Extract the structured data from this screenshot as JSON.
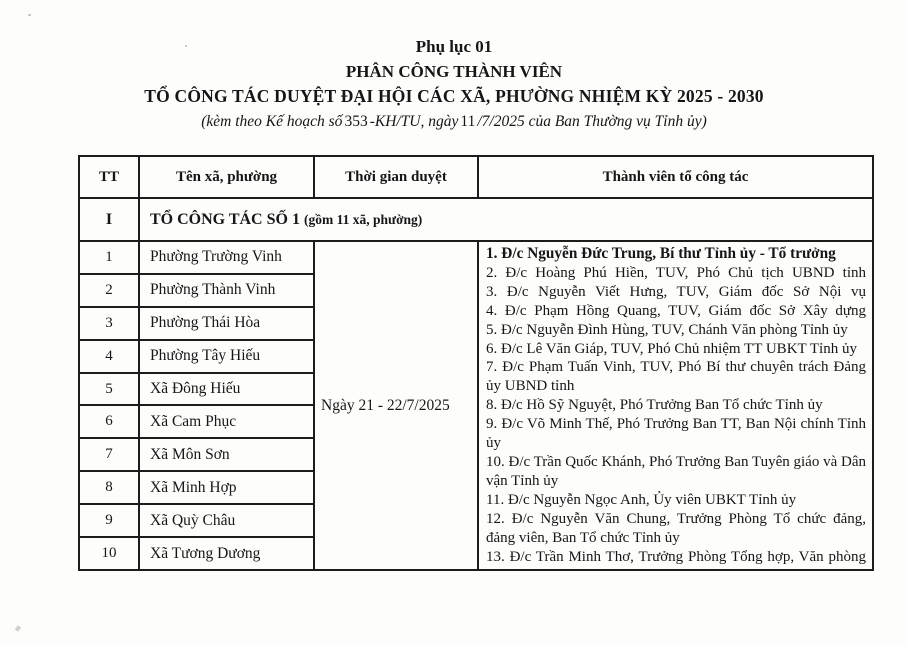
{
  "header": {
    "appendix": "Phụ lục 01",
    "title1": "PHÂN CÔNG THÀNH VIÊN",
    "title2": "TỔ CÔNG TÁC DUYỆT ĐẠI HỘI CÁC XÃ, PHƯỜNG NHIỆM KỲ 2025 - 2030",
    "subtitle": {
      "prefix": "(kèm theo Kế hoạch số",
      "number1": "353",
      "mid": "-KH/TU, ngày",
      "number2": "11",
      "suffix": "/7/2025 của Ban Thường vụ Tỉnh ủy)"
    }
  },
  "table": {
    "headers": [
      "TT",
      "Tên xã, phường",
      "Thời gian duyệt",
      "Thành viên tổ công tác"
    ],
    "section": {
      "tt": "I",
      "title": "TỔ CÔNG TÁC SỐ 1",
      "subtitle": "(gồm 11 xã, phường)"
    },
    "time": "Ngày 21 - 22/7/2025",
    "rows": [
      {
        "tt": "1",
        "name": "Phường Trường Vinh"
      },
      {
        "tt": "2",
        "name": "Phường Thành Vinh"
      },
      {
        "tt": "3",
        "name": "Phường Thái Hòa"
      },
      {
        "tt": "4",
        "name": "Phường Tây Hiếu"
      },
      {
        "tt": "5",
        "name": "Xã Đông Hiếu"
      },
      {
        "tt": "6",
        "name": "Xã Cam Phục"
      },
      {
        "tt": "7",
        "name": "Xã Môn Sơn"
      },
      {
        "tt": "8",
        "name": "Xã Minh Hợp"
      },
      {
        "tt": "9",
        "name": "Xã Quỳ Châu"
      },
      {
        "tt": "10",
        "name": "Xã Tương Dương"
      }
    ],
    "members": [
      "1. Đ/c  Nguyễn Đức Trung, Bí thư Tỉnh ủy - Tổ trưởng",
      "2. Đ/c Hoàng Phú Hiền, TUV, Phó Chủ tịch UBND tỉnh",
      "3. Đ/c Nguyễn Viết Hưng, TUV, Giám đốc Sở Nội vụ",
      "4. Đ/c Phạm Hồng Quang, TUV, Giám đốc Sở Xây dựng",
      "5. Đ/c Nguyễn Đình Hùng, TUV, Chánh Văn phòng Tỉnh ủy",
      "6. Đ/c Lê Văn Giáp, TUV, Phó Chủ nhiệm TT UBKT Tỉnh ủy",
      "7. Đ/c Phạm Tuấn Vinh, TUV, Phó Bí thư chuyên trách Đảng ủy UBND tỉnh",
      "8. Đ/c Hồ Sỹ Nguyệt, Phó Trưởng Ban Tổ chức Tỉnh ủy",
      "9. Đ/c Võ Minh Thế, Phó Trưởng Ban TT, Ban Nội chính Tỉnh ủy",
      "10. Đ/c Trần Quốc Khánh, Phó Trưởng Ban Tuyên giáo và Dân vận Tỉnh ủy",
      "11. Đ/c Nguyễn Ngọc Anh, Ủy viên UBKT Tỉnh ủy",
      "12. Đ/c Nguyễn Văn Chung, Trưởng Phòng Tổ chức đảng, đảng viên, Ban Tổ chức Tỉnh ủy",
      "13. Đ/c Trần Minh Thơ, Trưởng Phòng Tổng hợp, Văn phòng Tỉnh ủy"
    ]
  }
}
